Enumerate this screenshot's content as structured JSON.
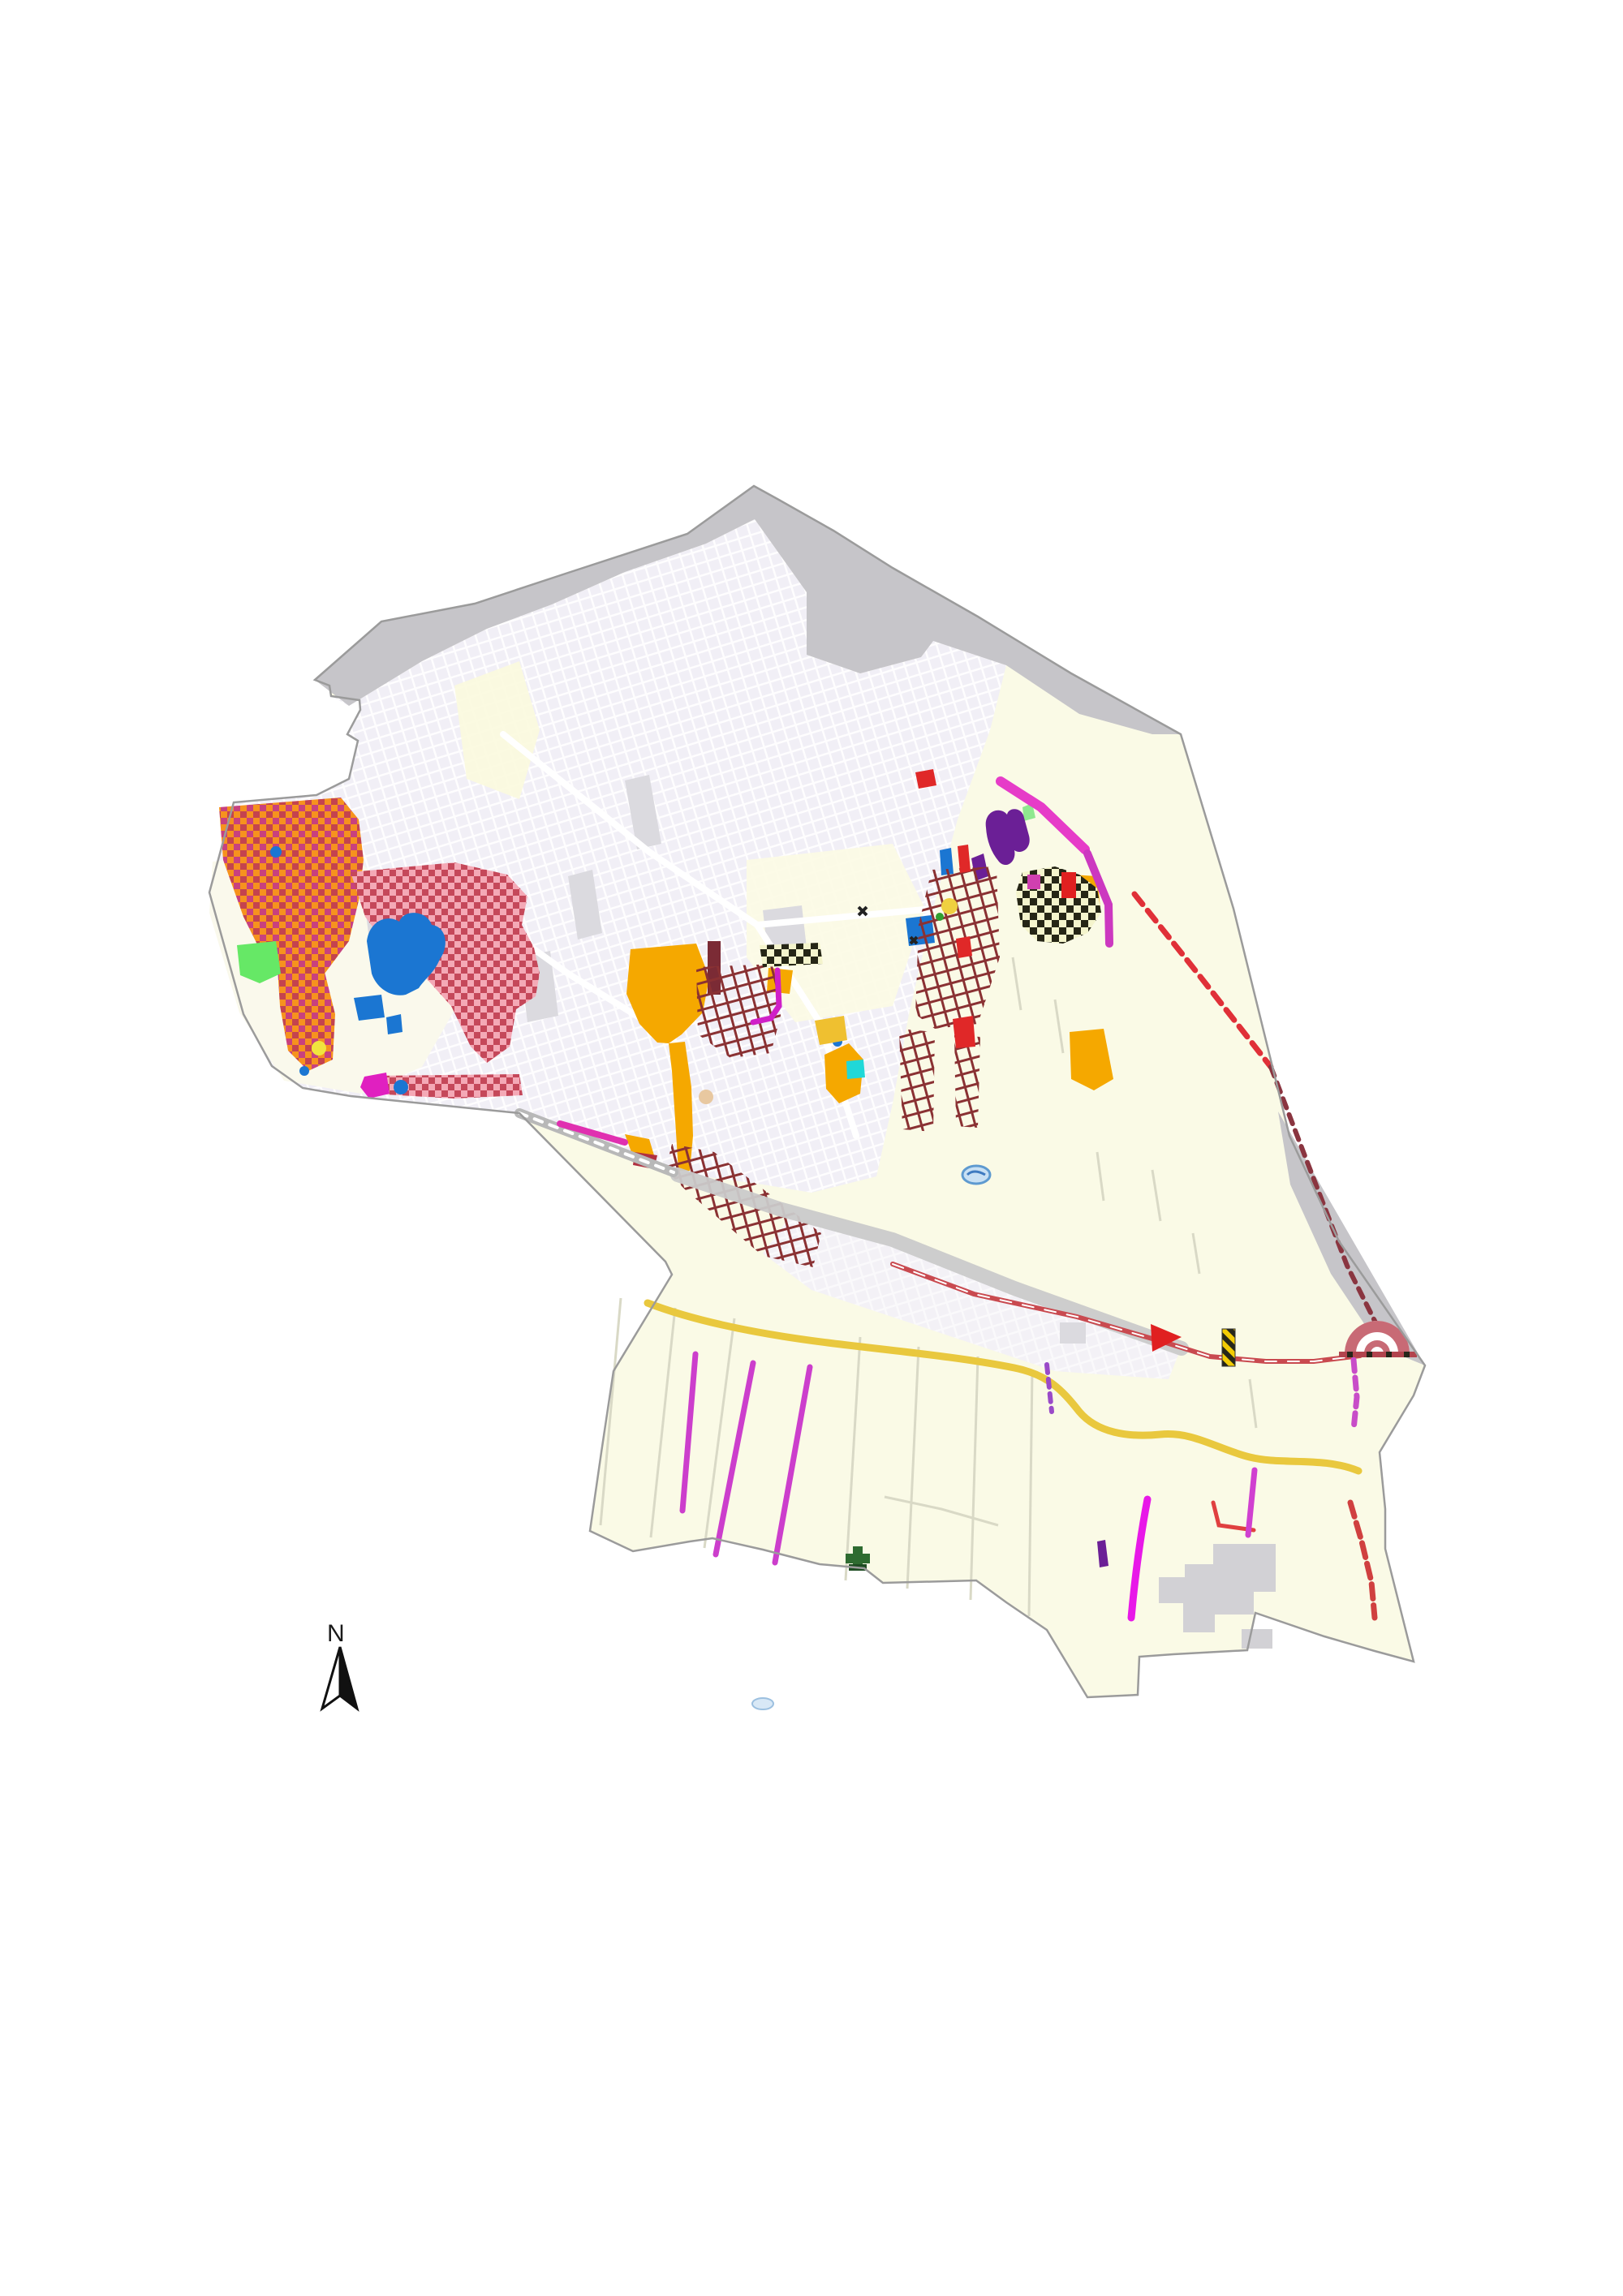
{
  "map": {
    "north_arrow": {
      "label": "N"
    },
    "palette": {
      "background": "#ffffff",
      "coast_gray": "#c6c5c9",
      "urban_fabric": "#f1eff6",
      "fields_cream": "#fafae6",
      "boundary_line": "#9b9b9b",
      "checker_orange": "#f6921e",
      "checker_orange_alt1": "#c8417e",
      "checker_orange_alt2": "#c4434f",
      "checker_pink": "#f4a9b6",
      "checker_pink_alt": "#c5485a",
      "checker_olive_bg": "#f4f4cc",
      "checker_olive_alt": "#262616",
      "crosshatch_maroon": "#8a3133",
      "blue_zone": "#1b76d2",
      "amber_zone": "#f5a800",
      "purple_zone": "#6b1f96",
      "green_zone": "#66e866",
      "magenta_zone": "#e020c0",
      "maroon_zone": "#7b2b35",
      "red_road": "#c94a50",
      "yellow_road": "#e9c83e",
      "field_line_magenta": "#cc3ecc",
      "pond_blue": "#c8e0f4",
      "cemetery_green": "#2e6b30",
      "hazard_yellow": "#f2cb05"
    },
    "features": [
      "coastal-gray-band",
      "municipal-boundary",
      "urban-street-grid",
      "orange-checker-zone",
      "pink-checker-zone",
      "olive-checker-zone",
      "blue-zones",
      "amber-zones",
      "purple-zones",
      "green-zone",
      "maroon-crosshatch-zones",
      "magenta-roads",
      "yellow-road",
      "red-roads",
      "field-parcel-lines",
      "amphitheater-arc",
      "hazard-strip",
      "cemetery-cross-icon",
      "ponds",
      "north-arrow"
    ]
  }
}
